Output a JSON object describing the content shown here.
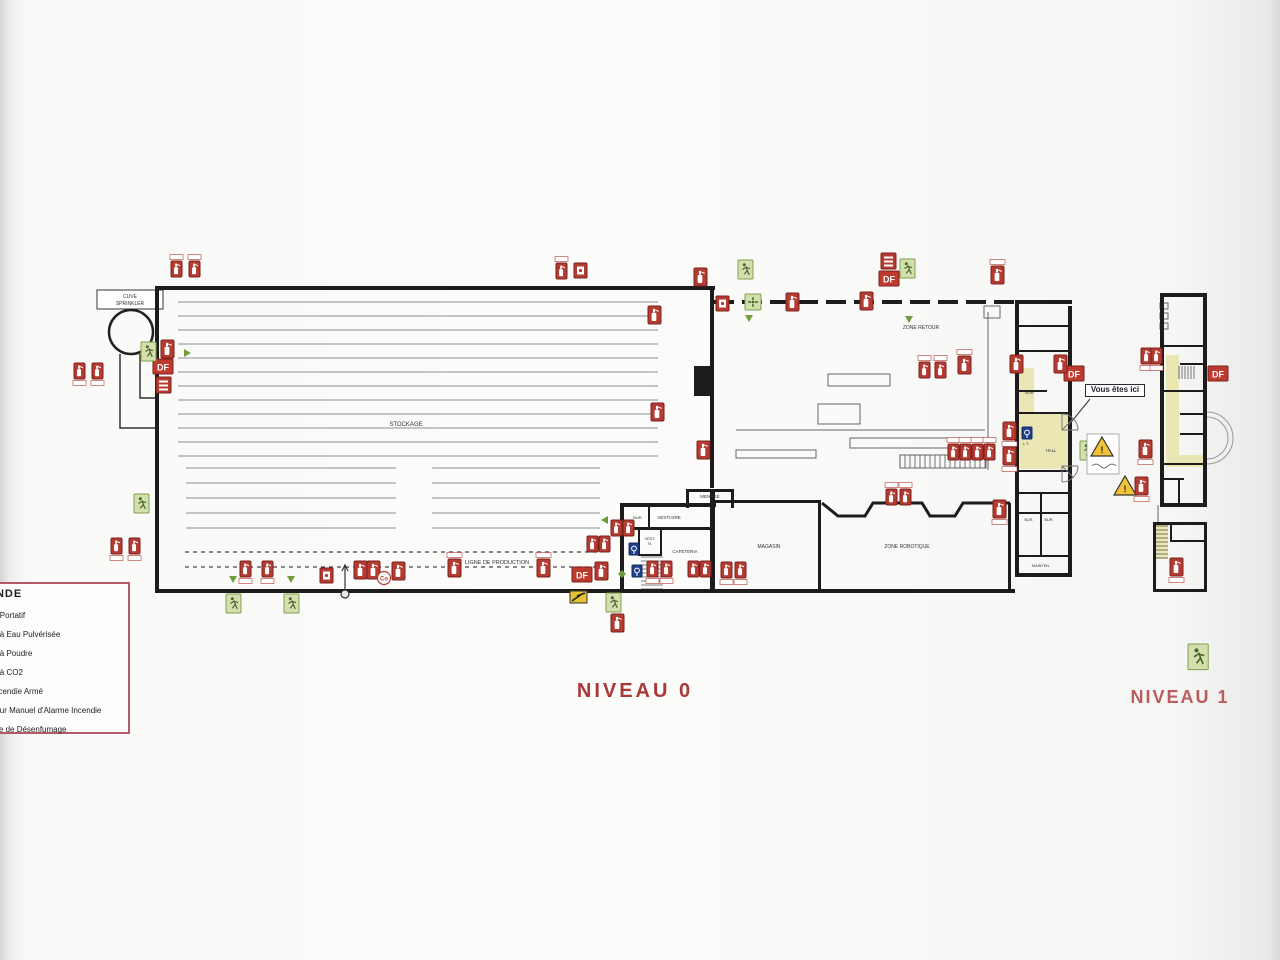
{
  "titles": {
    "niveau0": "NIVEAU 0",
    "niveau1": "NIVEAU 1"
  },
  "legend": {
    "title": "LÉGENDE",
    "items": [
      "Extincteur Portatif",
      "Extincteur à Eau Pulvérisée",
      "Extincteur à Poudre",
      "Extincteur à CO2",
      "Robinet Incendie Armé",
      "Déclencheur Manuel d'Alarme Incendie",
      "Commande de Désenfumage"
    ]
  },
  "callout": {
    "text": "Vous êtes ici"
  },
  "df_label": "DF",
  "colors": {
    "wall": "#1c1c1c",
    "red": "#b43b32",
    "redDark": "#7c211c",
    "red2": "#bf3a2e",
    "green": "#6f9c3c",
    "greenPale": "#d3dfad",
    "greenDark": "#49632c",
    "yellow": "#ebe7b5",
    "blue": "#20408f",
    "grey": "#777777",
    "thin": "#8a8f94"
  },
  "plan": {
    "walls": [
      [
        155,
        286,
        560,
        4
      ],
      [
        155,
        286,
        4,
        307
      ],
      [
        155,
        589,
        860,
        4
      ],
      [
        710,
        286,
        4,
        202
      ],
      [
        694,
        366,
        17,
        30
      ],
      [
        1015,
        300,
        57,
        4
      ],
      [
        1015,
        300,
        4,
        277
      ],
      [
        1068,
        306,
        4,
        271
      ],
      [
        1015,
        573,
        57,
        4
      ],
      [
        620,
        503,
        4,
        90
      ],
      [
        620,
        503,
        96,
        4
      ],
      [
        710,
        489,
        5,
        104
      ],
      [
        686,
        489,
        48,
        3
      ],
      [
        686,
        489,
        3,
        19
      ],
      [
        731,
        489,
        3,
        19
      ],
      [
        622,
        527,
        92,
        3
      ],
      [
        648,
        506,
        2,
        21
      ],
      [
        638,
        530,
        2,
        26
      ],
      [
        638,
        554,
        24,
        2
      ],
      [
        660,
        530,
        2,
        26
      ],
      [
        715,
        500,
        59,
        3
      ],
      [
        772,
        500,
        49,
        3
      ],
      [
        818,
        500,
        3,
        92
      ],
      [
        1008,
        503,
        3,
        88
      ],
      [
        1019,
        325,
        49,
        2
      ],
      [
        1019,
        350,
        49,
        2
      ],
      [
        1019,
        390,
        28,
        2
      ],
      [
        1019,
        412,
        49,
        2
      ],
      [
        1019,
        470,
        49,
        2
      ],
      [
        1019,
        492,
        49,
        2
      ],
      [
        1019,
        512,
        49,
        2
      ],
      [
        1019,
        555,
        49,
        2
      ],
      [
        1040,
        492,
        2,
        63
      ],
      [
        1160,
        293,
        47,
        4
      ],
      [
        1160,
        293,
        4,
        214
      ],
      [
        1203,
        293,
        4,
        214
      ],
      [
        1160,
        503,
        47,
        4
      ],
      [
        1164,
        345,
        41,
        2
      ],
      [
        1180,
        363,
        27,
        2
      ],
      [
        1164,
        390,
        41,
        2
      ],
      [
        1180,
        413,
        25,
        2
      ],
      [
        1180,
        433,
        25,
        2
      ],
      [
        1164,
        463,
        41,
        2
      ],
      [
        1164,
        478,
        20,
        2
      ],
      [
        1178,
        478,
        2,
        27
      ],
      [
        1153,
        522,
        54,
        3
      ],
      [
        1153,
        522,
        3,
        70
      ],
      [
        1204,
        522,
        3,
        70
      ],
      [
        1153,
        589,
        54,
        3
      ],
      [
        1170,
        540,
        37,
        2
      ],
      [
        1170,
        522,
        2,
        20
      ]
    ],
    "dash": [
      {
        "x1": 714,
        "y1": 302,
        "x2": 1015,
        "y2": 302,
        "sw": 4,
        "da": "20,8",
        "c": "#1c1c1c"
      },
      {
        "x1": 185,
        "y1": 552,
        "x2": 600,
        "y2": 552,
        "sw": 1.2,
        "da": "4,4",
        "c": "#444444"
      },
      {
        "x1": 185,
        "y1": 567,
        "x2": 600,
        "y2": 567,
        "sw": 1.2,
        "da": "4,4",
        "c": "#444444"
      }
    ],
    "thin": [
      [
        988,
        312,
        988,
        470
      ],
      [
        736,
        430,
        985,
        430
      ],
      [
        1158,
        505,
        1158,
        522
      ]
    ],
    "trect": [
      [
        828,
        374,
        62,
        12
      ],
      [
        818,
        404,
        42,
        20
      ],
      [
        850,
        438,
        138,
        10
      ],
      [
        736,
        450,
        80,
        8
      ],
      [
        900,
        455,
        86,
        13
      ],
      [
        984,
        306,
        16,
        12
      ],
      [
        1160,
        303,
        8,
        6
      ],
      [
        1160,
        313,
        8,
        6
      ],
      [
        1160,
        323,
        8,
        6
      ]
    ],
    "boxes": [
      [
        97,
        290,
        66,
        19
      ]
    ],
    "paths": [
      {
        "d": "M120,354 L120,428 L155,428 M140,354 L140,398 L155,398",
        "s": "#333333",
        "sw": 1.5
      },
      {
        "d": "M1090,399 L1068,426",
        "s": "#333333",
        "sw": 1
      },
      {
        "d": "M1207,412 A26,26 0 0 1 1207,464",
        "s": "#999999",
        "sw": 1
      },
      {
        "d": "M1207,417 A21,21 0 0 1 1207,459",
        "s": "#999999",
        "sw": 1
      },
      {
        "d": "M1062,414 A16,16 0 0 1 1078,430 M1062,430 L1073,419 M1062,430 L1078,430 M1062,430 L1062,414",
        "s": "#777777",
        "sw": 1
      },
      {
        "d": "M1078,466 A16,16 0 0 1 1062,482 M1062,466 L1078,466 M1062,466 L1073,477 M1062,466 L1062,482",
        "s": "#777777",
        "sw": 1
      }
    ],
    "circles": [
      [
        131,
        332,
        22,
        "none",
        "#222222",
        2.5
      ]
    ],
    "yellow": [
      [
        1018,
        413,
        50,
        56
      ],
      [
        1018,
        368,
        16,
        45
      ],
      [
        1166,
        355,
        13,
        112
      ],
      [
        1179,
        455,
        24,
        12
      ],
      [
        1166,
        366,
        14,
        14
      ],
      [
        1155,
        525,
        13,
        34
      ]
    ],
    "treads": [
      [
        641,
        557,
        22,
        32,
        4,
        "h"
      ],
      [
        1179,
        366,
        16,
        13,
        3,
        "v"
      ],
      [
        1155,
        526,
        13,
        32,
        4,
        "h"
      ],
      [
        900,
        455,
        86,
        13,
        5,
        "v"
      ]
    ],
    "racks": [
      {
        "x1": 178,
        "x2": 658,
        "y0": 302,
        "dy": 14,
        "n": 12
      },
      {
        "x1": 186,
        "x2": 396,
        "y0": 468,
        "dy": 15,
        "n": 5
      },
      {
        "x1": 432,
        "x2": 600,
        "y0": 468,
        "dy": 15,
        "n": 5
      }
    ],
    "labels": [
      [
        "STOCKAGE",
        406,
        426,
        6
      ],
      [
        "ZONE RETOUR",
        921,
        329,
        5
      ],
      [
        "LIGNE DE PRODUCTION",
        497,
        564,
        5.5
      ],
      [
        "MAGASIN",
        769,
        548,
        5
      ],
      [
        "ZONE ROBOTIQUE",
        907,
        548,
        5
      ],
      [
        "MENAGE",
        710,
        498,
        4.5
      ],
      [
        "VESTIAIRE",
        669,
        519,
        4.5
      ],
      [
        "BUR.",
        638,
        519,
        4
      ],
      [
        "VEST.",
        650,
        540,
        3.8
      ],
      [
        "N.",
        650,
        545,
        3.8
      ],
      [
        "CAFETERIA",
        685,
        553,
        4.5
      ],
      [
        "HALL",
        1051,
        452,
        4.2
      ],
      [
        "BUR.",
        1030,
        394,
        4
      ],
      [
        "L.T.",
        1026,
        445,
        3.8
      ],
      [
        "BUR.",
        1029,
        521,
        3.8
      ],
      [
        "BUR.",
        1049,
        521,
        3.8
      ],
      [
        "MAINTEN.",
        1041,
        567,
        3.8
      ],
      [
        "CUVE",
        130,
        298,
        5
      ],
      [
        "SPRINKLER",
        130,
        305,
        5
      ]
    ],
    "zigzag": {
      "d": "M822,503 L838,516 L865,516 L873,503 L922,503 L930,516 L955,516 L963,503 L1010,503",
      "sw": 3
    },
    "icons": [
      [
        "extp",
        171,
        261,
        {
          "tt": 1
        }
      ],
      [
        "extp",
        189,
        261,
        {
          "tt": 1
        }
      ],
      [
        "extp",
        556,
        263,
        {
          "tt": 1
        }
      ],
      [
        "alarm",
        574,
        263,
        {}
      ],
      [
        "ext",
        648,
        306,
        {}
      ],
      [
        "ext",
        651,
        403,
        {}
      ],
      [
        "ext",
        697,
        441,
        {}
      ],
      [
        "extp",
        74,
        363,
        {
          "tb": 1
        }
      ],
      [
        "extp",
        92,
        363,
        {
          "tb": 1
        }
      ],
      [
        "ext",
        161,
        340,
        {}
      ],
      [
        "df",
        153,
        359,
        {}
      ],
      [
        "vent",
        156,
        377,
        {}
      ],
      [
        "extp",
        111,
        538,
        {
          "tb": 1
        }
      ],
      [
        "extp",
        129,
        538,
        {
          "tb": 1
        }
      ],
      [
        "extp",
        240,
        561,
        {
          "tb": 1
        }
      ],
      [
        "extp",
        262,
        561,
        {
          "tb": 1
        }
      ],
      [
        "alarm",
        320,
        568,
        {}
      ],
      [
        "ext",
        354,
        561,
        {}
      ],
      [
        "ext",
        367,
        561,
        {}
      ],
      [
        "co",
        384,
        578,
        {}
      ],
      [
        "ext",
        392,
        562,
        {}
      ],
      [
        "ext",
        448,
        559,
        {
          "tt": 1
        }
      ],
      [
        "ext",
        537,
        559,
        {
          "tt": 1
        }
      ],
      [
        "df",
        572,
        567,
        {}
      ],
      [
        "ext",
        595,
        562,
        {}
      ],
      [
        "extp",
        587,
        536,
        {}
      ],
      [
        "extp",
        599,
        536,
        {}
      ],
      [
        "extp",
        611,
        520,
        {}
      ],
      [
        "extp",
        623,
        520,
        {}
      ],
      [
        "ria",
        629,
        543,
        {}
      ],
      [
        "ria",
        632,
        565,
        {}
      ],
      [
        "extp",
        647,
        561,
        {
          "tb": 1
        }
      ],
      [
        "extp",
        661,
        561,
        {
          "tb": 1
        }
      ],
      [
        "extp",
        688,
        561,
        {}
      ],
      [
        "extp",
        700,
        561,
        {}
      ],
      [
        "extp",
        721,
        562,
        {
          "tb": 1
        }
      ],
      [
        "extp",
        735,
        562,
        {
          "tb": 1
        }
      ],
      [
        "extp",
        886,
        489,
        {
          "tt": 1
        }
      ],
      [
        "extp",
        900,
        489,
        {
          "tt": 1
        }
      ],
      [
        "ext",
        993,
        500,
        {
          "tb": 1
        }
      ],
      [
        "extp",
        919,
        362,
        {
          "tt": 1
        }
      ],
      [
        "extp",
        935,
        362,
        {
          "tt": 1
        }
      ],
      [
        "ext",
        958,
        356,
        {
          "tt": 1
        }
      ],
      [
        "extp",
        948,
        444,
        {
          "tt": 1
        }
      ],
      [
        "extp",
        960,
        444,
        {
          "tt": 1
        }
      ],
      [
        "extp",
        972,
        444,
        {
          "tt": 1
        }
      ],
      [
        "extp",
        984,
        444,
        {
          "tt": 1
        }
      ],
      [
        "ext",
        1003,
        422,
        {
          "tb": 1
        }
      ],
      [
        "ext",
        1003,
        447,
        {
          "tb": 1
        }
      ],
      [
        "ria",
        1022,
        427,
        {}
      ],
      [
        "ext",
        694,
        268,
        {}
      ],
      [
        "alarm",
        716,
        296,
        {}
      ],
      [
        "ext",
        786,
        293,
        {}
      ],
      [
        "ext",
        860,
        292,
        {}
      ],
      [
        "vent",
        881,
        253,
        {}
      ],
      [
        "df",
        879,
        271,
        {}
      ],
      [
        "exit",
        900,
        259,
        {}
      ],
      [
        "ext",
        991,
        266,
        {
          "tt": 1
        }
      ],
      [
        "exit",
        738,
        260,
        {}
      ],
      [
        "assembly",
        745,
        294,
        {}
      ],
      [
        "exit",
        141,
        342,
        {}
      ],
      [
        "exit",
        134,
        494,
        {}
      ],
      [
        "exit",
        226,
        594,
        {}
      ],
      [
        "exit",
        284,
        594,
        {}
      ],
      [
        "exit",
        606,
        593,
        {}
      ],
      [
        "ext",
        611,
        614,
        {}
      ],
      [
        "cross",
        570,
        591,
        {}
      ],
      [
        "exit",
        1080,
        441,
        {}
      ],
      [
        "warnbox",
        1091,
        437,
        {}
      ],
      [
        "warn",
        1114,
        476,
        {}
      ],
      [
        "ext",
        1135,
        477,
        {
          "tb": 1
        }
      ],
      [
        "ext",
        1139,
        440,
        {
          "tb": 1
        }
      ],
      [
        "extp",
        1141,
        348,
        {
          "tb": 1
        }
      ],
      [
        "extp",
        1151,
        348,
        {
          "tb": 1
        }
      ],
      [
        "ext",
        1170,
        558,
        {
          "tb": 1
        }
      ],
      [
        "df",
        1208,
        366,
        {}
      ],
      [
        "df",
        1064,
        366,
        {}
      ],
      [
        "ext",
        1010,
        355,
        {}
      ],
      [
        "ext",
        1054,
        355,
        {}
      ],
      [
        "exitL",
        1188,
        644,
        {}
      ],
      [
        "arrowD",
        229,
        576,
        {}
      ],
      [
        "arrowD",
        287,
        576,
        {}
      ],
      [
        "arrowR",
        184,
        349,
        {}
      ],
      [
        "arrowD",
        745,
        315,
        {}
      ],
      [
        "arrowD",
        905,
        316,
        {}
      ],
      [
        "arrowDi",
        618,
        570,
        {}
      ],
      [
        "arrowL",
        601,
        516,
        {}
      ],
      [
        "hydrant",
        345,
        594,
        {}
      ]
    ]
  }
}
